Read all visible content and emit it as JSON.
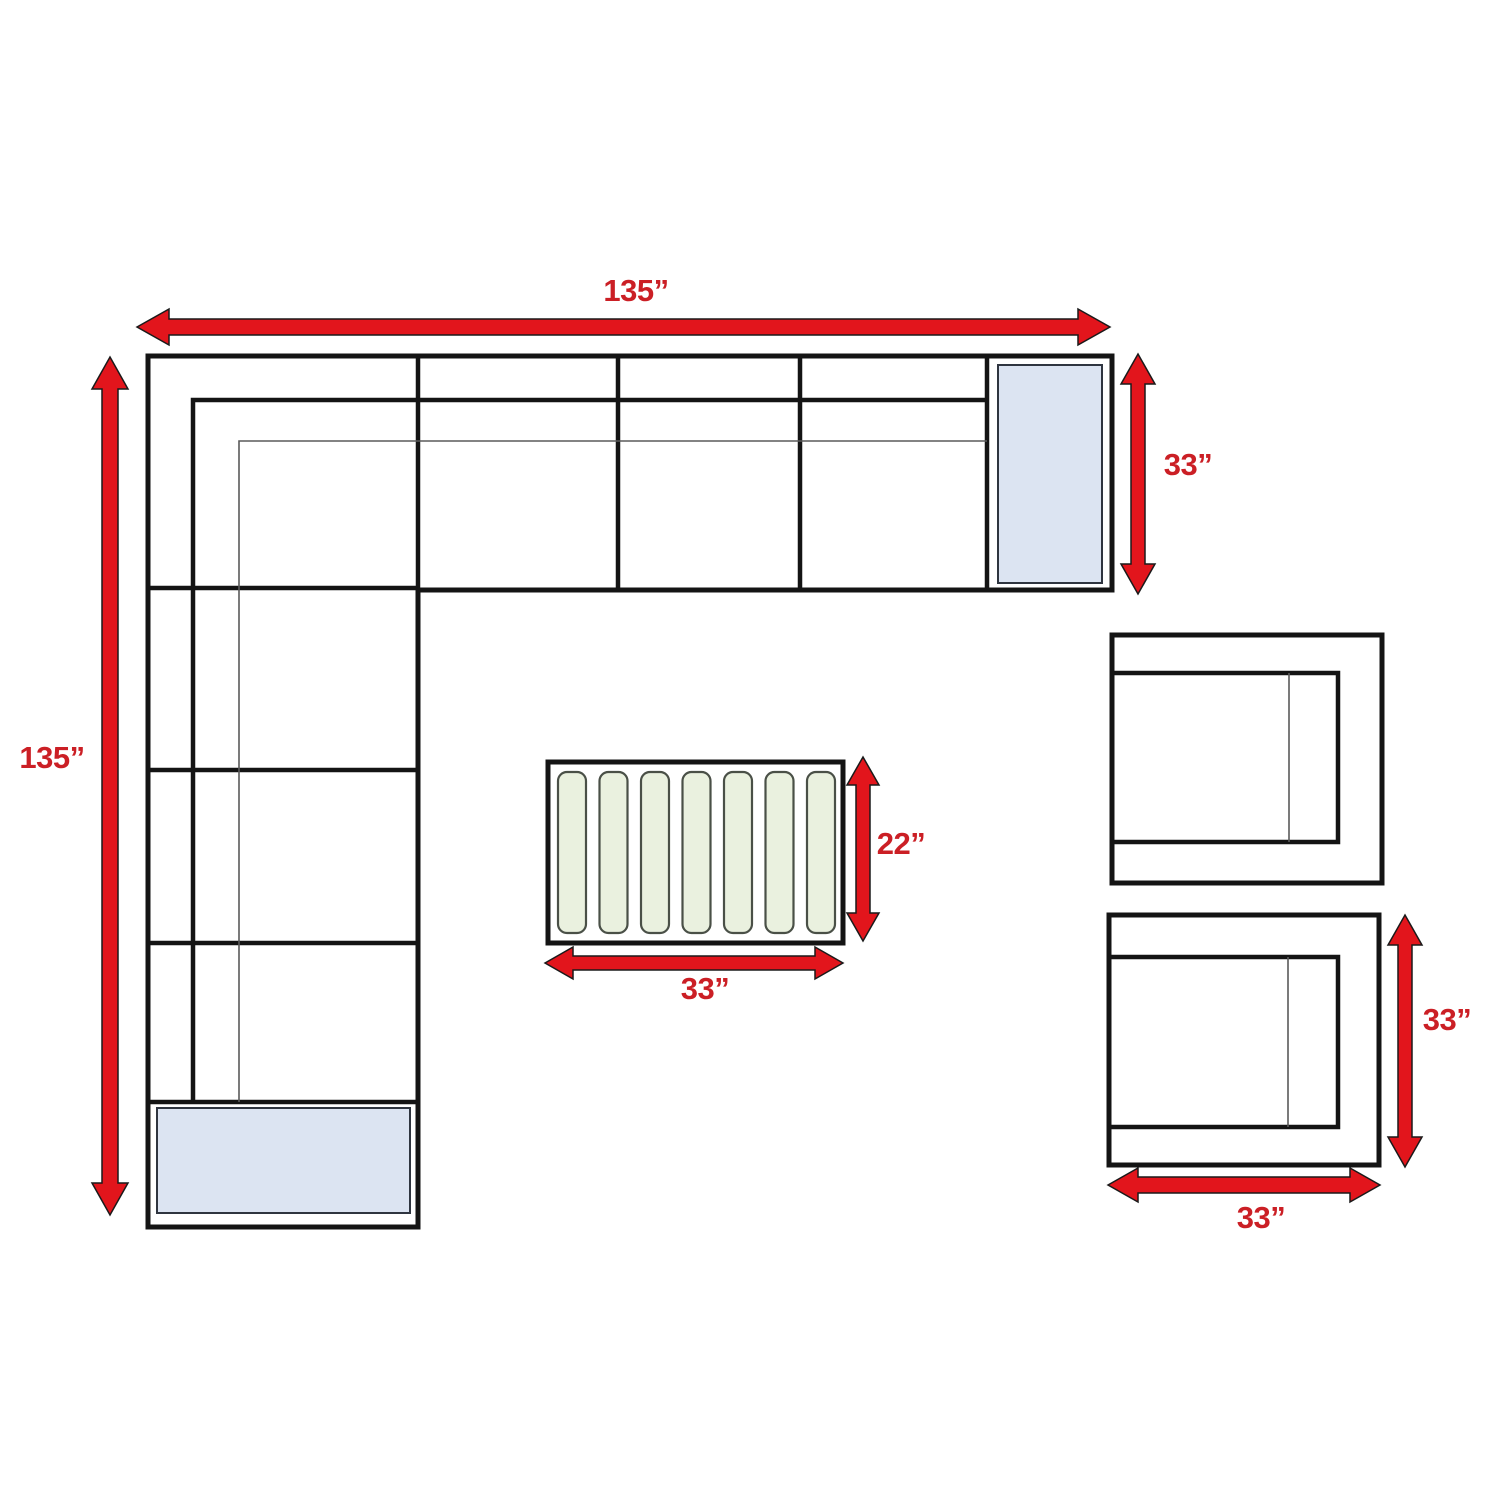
{
  "diagram": {
    "type": "furniture-dimension-plan",
    "colors": {
      "outline_black": "#141414",
      "thin_line_gray": "#5a5a5a",
      "arrow_red": "#E2151C",
      "label_red": "#CB1F25",
      "cushion_blue": "#DCE4F2",
      "slat_green": "#EAF1DF",
      "background": "#ffffff"
    },
    "sectional": {
      "width_label": "135”",
      "depth_label": "135”",
      "end_depth_label": "33”"
    },
    "coffee_table": {
      "width_label": "33”",
      "depth_label": "22”"
    },
    "armchair": {
      "width_label": "33”",
      "depth_label": "33”"
    }
  }
}
